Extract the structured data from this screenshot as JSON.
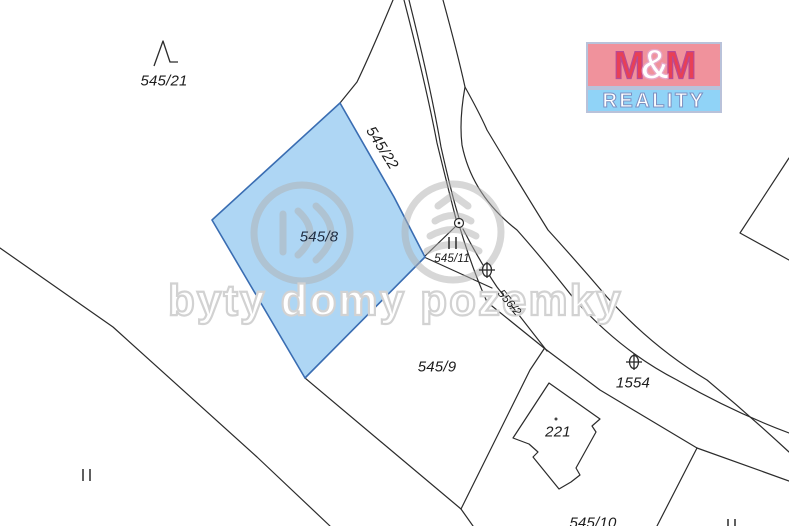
{
  "logo": {
    "m1": "M",
    "amp": "&",
    "m2": "M",
    "reality": "REALITY",
    "colors": {
      "top_background": "#f0929c",
      "m_letters": "#e84055",
      "bottom_background": "#90d3f7",
      "reality_letters": "#ffffff"
    }
  },
  "watermark": {
    "text": "byty domy pozemky",
    "color": "#d2d2d2"
  },
  "map": {
    "type": "cadastral-parcel-map",
    "highlighted_parcel": "545/8",
    "colors": {
      "highlight_fill": "#aed6f4",
      "highlight_stroke": "#3a6db2",
      "boundary_line": "#2b2b2b",
      "background": "#ffffff"
    },
    "labels": [
      {
        "text": "545/21"
      },
      {
        "text": "545/22"
      },
      {
        "text": "545/8"
      },
      {
        "text": "545/11"
      },
      {
        "text": "556/2"
      },
      {
        "text": "545/9"
      },
      {
        "text": "1554"
      },
      {
        "text": "221"
      },
      {
        "text": "545/10"
      }
    ],
    "symbols": [
      {
        "name": "tree-symbol",
        "near_parcel": "545/21"
      },
      {
        "name": "boundary-point-circle",
        "near_parcel": "545/11"
      },
      {
        "name": "grassland-symbol",
        "near_parcel": "545/11"
      },
      {
        "name": "grassland-symbol",
        "near_parcel": "bottom-left"
      },
      {
        "name": "grassland-symbol",
        "near_parcel": "bottom-right"
      },
      {
        "name": "orchard-symbol",
        "near_parcel": "556/2"
      },
      {
        "name": "orchard-symbol",
        "near_parcel": "1554"
      },
      {
        "name": "building-dot",
        "near_parcel": "221"
      }
    ]
  }
}
